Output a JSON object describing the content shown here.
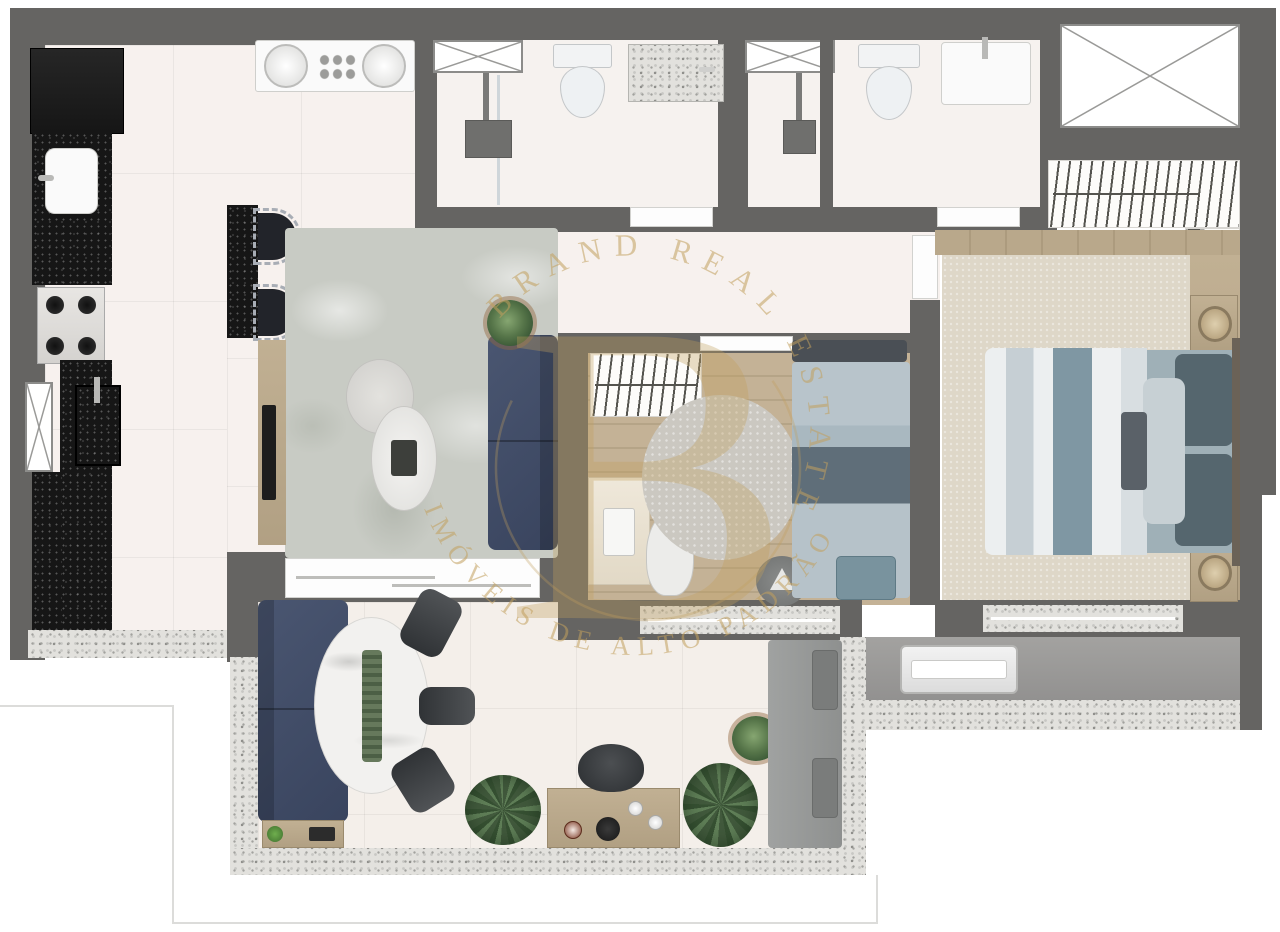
{
  "title": "apartment-floor-plan",
  "watermark": {
    "arc_top": "BRAND REAL ESTATE",
    "arc_bottom": "IMÓVEIS DE ALTO PADRÃO",
    "monogram": "B",
    "color": "#c2a05e"
  },
  "palette": {
    "wall": "#656462",
    "floor": "#f7f1ee",
    "balcony_floor": "#f4efea",
    "black_counter": "#161616",
    "navy": "#3f4a63",
    "wood": "#bcab8e",
    "rug_living": "#c8cbc4",
    "rug_master": "#ded7c8",
    "teal": "#7f97a3",
    "speckle_base": "#e2e1dd",
    "concrete": "#9e9d9b",
    "gold": "#c2a05e",
    "fixture_white": "#fafafa"
  },
  "inventory": {
    "kitchen": [
      "refrigerator",
      "granite-counter",
      "kitchen-sink",
      "cooktop-4-burner",
      "laundry-sink",
      "washer-dryer-pair",
      "island-counter",
      "bar-stools",
      "wall-window"
    ],
    "bathroom_1": [
      "window",
      "shower-head",
      "glass-divider",
      "toilet",
      "vanity",
      "door"
    ],
    "bathroom_2": [
      "window",
      "shower-head",
      "divider-wall",
      "toilet",
      "vanity",
      "door"
    ],
    "living_room": [
      "area-rug",
      "tv-console",
      "tv",
      "coffee-table-pair",
      "sofa",
      "plant",
      "sliding-door"
    ],
    "bedroom_2": [
      "wardrobe",
      "desk",
      "office-chair",
      "round-rug",
      "single-bed",
      "foot-bench",
      "side-table-lamp",
      "window-band",
      "door"
    ],
    "master_bedroom": [
      "walk-in-closet",
      "double-bed",
      "pillows",
      "headboard",
      "nightstand-with-lamp",
      "area-rug",
      "window-band",
      "door"
    ],
    "balcony": [
      "sofa",
      "serving-tray",
      "oval-dining-table",
      "table-runner",
      "dining-chairs",
      "palm-plants",
      "potted-plant",
      "sideboard-coffee-bar",
      "lounge-chair",
      "corner-bench"
    ],
    "service_corridor": [
      "condenser-unit"
    ],
    "technical_shaft": [
      "x-window"
    ]
  }
}
